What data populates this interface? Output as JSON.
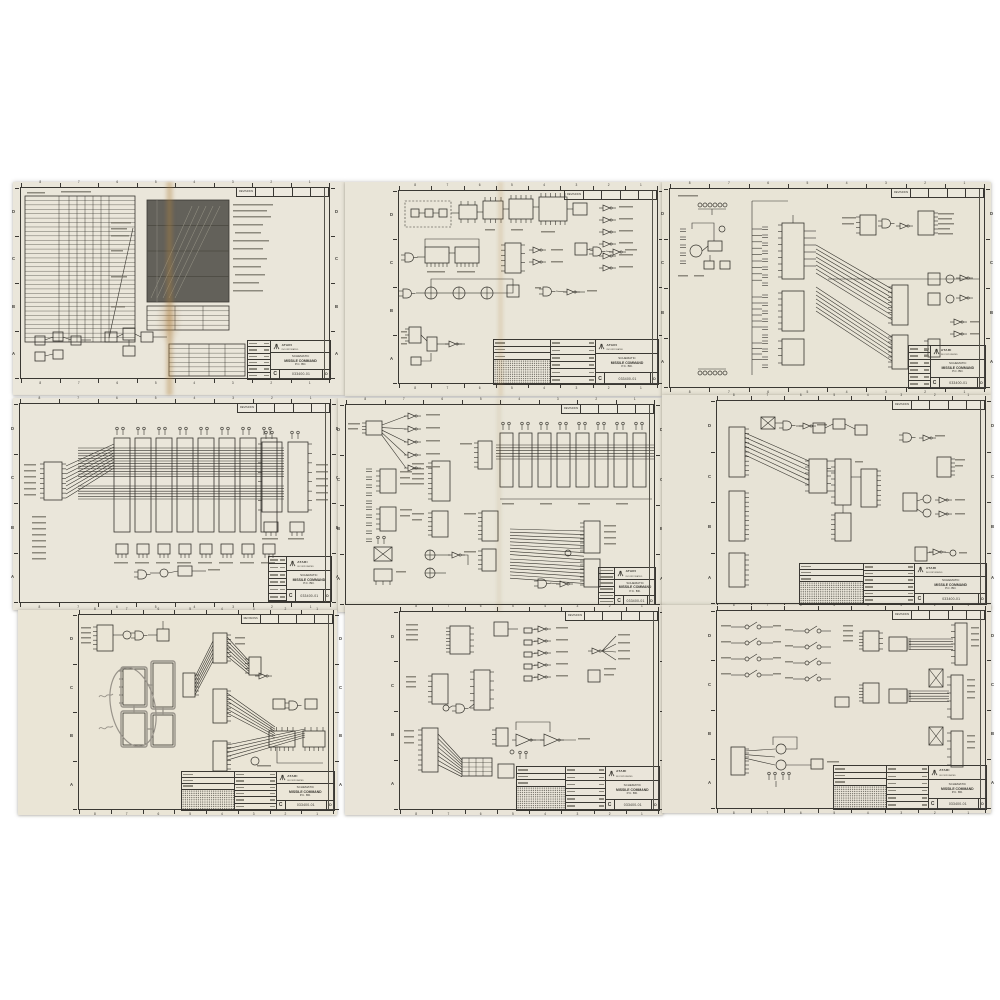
{
  "colors": {
    "background": "#ffffff",
    "paper": "#e9e5d9",
    "ink": "#35332d",
    "pencil": "#98938a",
    "stain": "#b48a50",
    "dark_chart": "#63615a",
    "text_bar": "#7d796d"
  },
  "zones": {
    "rows": [
      "D",
      "C",
      "B",
      "A"
    ],
    "cols": [
      "8",
      "7",
      "6",
      "5",
      "4",
      "3",
      "2",
      "1"
    ]
  },
  "revisions_label": "REVISIONS",
  "title_block": {
    "company": "ATARI",
    "company_sub": "INCORPORATED",
    "title_label": "SCHEMATIC",
    "game": "MISSILE COMMAND",
    "board": "P.C. BD.",
    "drawing_number": "033400-01",
    "rev": "D",
    "size": "C"
  },
  "sheets": [
    {
      "name": "parts-list-and-timing-chart-sheet"
    },
    {
      "name": "sync-and-control-logic-sheet"
    },
    {
      "name": "cpu-and-address-decode-sheet"
    },
    {
      "name": "ram-array-sheet"
    },
    {
      "name": "rom-and-video-logic-sheet"
    },
    {
      "name": "video-output-logic-sheet"
    },
    {
      "name": "annotated-logic-sheet"
    },
    {
      "name": "audio-output-sheet"
    },
    {
      "name": "switch-input-and-connector-sheet"
    }
  ]
}
